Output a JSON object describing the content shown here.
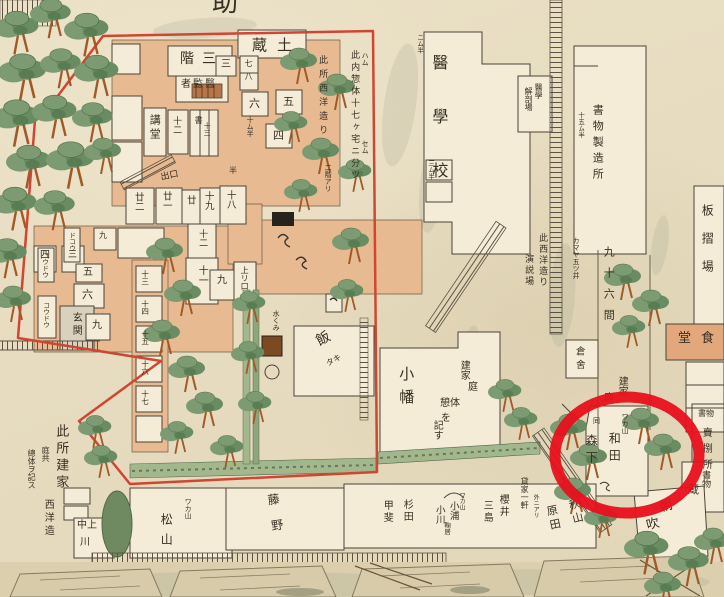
{
  "map": {
    "title_fragment": "助",
    "palette": {
      "ink": "#372f23",
      "boundary_red": "#cf4733",
      "annotation_red": "#e8101c",
      "corridor_salmon": "#e8ba92",
      "dining_salmon": "#e2a87c",
      "room_white": "#f4ecd6",
      "hedge_green": "#a2b88c",
      "tree_green": "#7d9b72",
      "moat_tan": "#dccfad"
    },
    "annotation": {
      "shape": "circle",
      "color": "#e8101c",
      "note": "red highlight circle over 和田 / 森下 plot"
    },
    "labels": [
      {
        "id": "title-fragment",
        "t": "助",
        "x": 212,
        "y": -10,
        "fs": 26,
        "d": "h"
      },
      {
        "id": "dozo",
        "t": "土蔵",
        "x": 252,
        "y": 38,
        "fs": 15,
        "d": "hr",
        "ls": 10
      },
      {
        "id": "sangai",
        "t": "三階",
        "x": 180,
        "y": 52,
        "fs": 14,
        "d": "hr",
        "ls": 8
      },
      {
        "id": "ikansha",
        "t": "醫監者",
        "x": 181,
        "y": 80,
        "fs": 10,
        "d": "hr",
        "ls": 2
      },
      {
        "id": "kodo",
        "t": "講堂",
        "x": 149,
        "y": 114,
        "fs": 11,
        "d": "v",
        "ls": 3
      },
      {
        "id": "juni-upper",
        "t": "十二",
        "x": 171,
        "y": 116,
        "fs": 9,
        "d": "v"
      },
      {
        "id": "sho",
        "t": "書",
        "x": 194,
        "y": 116,
        "fs": 8,
        "d": "v"
      },
      {
        "id": "jusan",
        "t": "十三",
        "x": 203,
        "y": 122,
        "fs": 7,
        "d": "v"
      },
      {
        "id": "num-3",
        "t": "三",
        "x": 221,
        "y": 60,
        "fs": 10,
        "d": "h"
      },
      {
        "id": "num-7-8",
        "t": "七八",
        "x": 244,
        "y": 59,
        "fs": 8,
        "d": "v",
        "ls": 5
      },
      {
        "id": "num-6",
        "t": "六",
        "x": 249,
        "y": 98,
        "fs": 11,
        "d": "h"
      },
      {
        "id": "num-5",
        "t": "五",
        "x": 283,
        "y": 96,
        "fs": 11,
        "d": "h"
      },
      {
        "id": "num-4",
        "t": "四",
        "x": 273,
        "y": 130,
        "fs": 11,
        "d": "h"
      },
      {
        "id": "konai-sobetai",
        "t": "此内惣体十七ヶ宅ニ分ツ",
        "x": 349,
        "y": 50,
        "fs": 9,
        "d": "v",
        "ls": 3
      },
      {
        "id": "kokosho-seiyo",
        "t": "此所西洋造り",
        "x": 317,
        "y": 55,
        "fs": 9,
        "d": "v",
        "ls": 5
      },
      {
        "id": "nikai-ari",
        "t": "二階アリ",
        "x": 324,
        "y": 164,
        "fs": 7,
        "d": "v"
      },
      {
        "id": "mark-hachimu",
        "t": "ハム",
        "x": 361,
        "y": 52,
        "fs": 7,
        "d": "v"
      },
      {
        "id": "mark-semu",
        "t": "セム",
        "x": 361,
        "y": 140,
        "fs": 7,
        "d": "v"
      },
      {
        "id": "mark-nimuhan",
        "t": "ニム半",
        "x": 416,
        "y": 34,
        "fs": 6.5,
        "d": "v"
      },
      {
        "id": "mark-jumuhan",
        "t": "十ム半",
        "x": 246,
        "y": 116,
        "fs": 7,
        "d": "v"
      },
      {
        "id": "deguchi",
        "t": "出口",
        "x": 160,
        "y": 174,
        "fs": 9,
        "d": "h",
        "r": -12
      },
      {
        "id": "room-18",
        "t": "十八",
        "x": 225,
        "y": 190,
        "fs": 9.5,
        "d": "v"
      },
      {
        "id": "room-19",
        "t": "十九",
        "x": 203,
        "y": 191,
        "fs": 9.5,
        "d": "v"
      },
      {
        "id": "room-20",
        "t": "廿",
        "x": 185,
        "y": 195,
        "fs": 9.5,
        "d": "v"
      },
      {
        "id": "room-21",
        "t": "廿一",
        "x": 161,
        "y": 191,
        "fs": 9.5,
        "d": "v"
      },
      {
        "id": "room-22",
        "t": "廿二",
        "x": 133,
        "y": 192,
        "fs": 9.5,
        "d": "v"
      },
      {
        "id": "mark-han",
        "t": "半",
        "x": 229,
        "y": 167,
        "fs": 8,
        "d": "h"
      },
      {
        "id": "room-12",
        "t": "十二",
        "x": 197,
        "y": 229,
        "fs": 9,
        "d": "v"
      },
      {
        "id": "room-11",
        "t": "十一",
        "x": 196,
        "y": 265,
        "fs": 10,
        "d": "v"
      },
      {
        "id": "room-9",
        "t": "九",
        "x": 217,
        "y": 276,
        "fs": 10,
        "d": "h"
      },
      {
        "id": "agariguchi",
        "t": "上リ口",
        "x": 240,
        "y": 266,
        "fs": 8,
        "d": "v"
      },
      {
        "id": "num-3b",
        "t": "三",
        "x": 68,
        "y": 251,
        "fs": 9,
        "d": "h"
      },
      {
        "id": "num-4b",
        "t": "四",
        "x": 40,
        "y": 251,
        "fs": 10,
        "d": "h"
      },
      {
        "id": "num-5b",
        "t": "五",
        "x": 83,
        "y": 268,
        "fs": 10,
        "d": "h"
      },
      {
        "id": "num-6b",
        "t": "六",
        "x": 82,
        "y": 289,
        "fs": 11,
        "d": "h"
      },
      {
        "id": "genkan",
        "t": "玄関",
        "x": 70,
        "y": 312,
        "fs": 10,
        "d": "v",
        "ls": 3
      },
      {
        "id": "num-9c",
        "t": "九",
        "x": 92,
        "y": 321,
        "fs": 10,
        "d": "h"
      },
      {
        "id": "num-9d",
        "t": "九",
        "x": 99,
        "y": 232,
        "fs": 8,
        "d": "h"
      },
      {
        "id": "koudou-1",
        "t": "コウドウ",
        "x": 42,
        "y": 302,
        "fs": 6.5,
        "d": "v"
      },
      {
        "id": "koudou-2",
        "t": "コウドウ",
        "x": 41,
        "y": 252,
        "fs": 6.5,
        "d": "v"
      },
      {
        "id": "dokou",
        "t": "ドコウ",
        "x": 68,
        "y": 232,
        "fs": 6.5,
        "d": "v"
      },
      {
        "id": "room-13",
        "t": "十三",
        "x": 141,
        "y": 270,
        "fs": 7.5,
        "d": "v"
      },
      {
        "id": "room-14",
        "t": "十四",
        "x": 141,
        "y": 300,
        "fs": 7.5,
        "d": "v"
      },
      {
        "id": "room-15",
        "t": "十五",
        "x": 141,
        "y": 330,
        "fs": 7.5,
        "d": "v"
      },
      {
        "id": "room-16",
        "t": "十六",
        "x": 141,
        "y": 360,
        "fs": 7.5,
        "d": "v"
      },
      {
        "id": "room-17",
        "t": "十七",
        "x": 141,
        "y": 390,
        "fs": 7.5,
        "d": "v"
      },
      {
        "id": "meshi",
        "t": "飯",
        "x": 314,
        "y": 336,
        "fs": 14,
        "d": "h",
        "r": -28
      },
      {
        "id": "meshi-taki",
        "t": "タキ",
        "x": 325,
        "y": 361,
        "fs": 8,
        "d": "h",
        "r": -28
      },
      {
        "id": "mizukumi",
        "t": "水くみ",
        "x": 272,
        "y": 310,
        "fs": 7,
        "d": "v"
      },
      {
        "id": "kamaya",
        "t": "カマヤ五ツ井",
        "x": 572,
        "y": 237,
        "fs": 7,
        "d": "v"
      },
      {
        "id": "kurasha",
        "t": "倉舍",
        "x": 574,
        "y": 346,
        "fs": 9.5,
        "d": "v",
        "ls": 4
      },
      {
        "id": "igakko",
        "t": "醫學校",
        "x": 430,
        "y": 54,
        "fs": 16,
        "d": "v",
        "ls": 38
      },
      {
        "id": "kaibo-igaku",
        "t": "醫學",
        "x": 534,
        "y": 83,
        "fs": 8,
        "d": "v"
      },
      {
        "id": "kaibo-jo",
        "t": "解剖場",
        "x": 524,
        "y": 87,
        "fs": 8,
        "d": "v"
      },
      {
        "id": "shomotsu-seizojo",
        "t": "書物製造所",
        "x": 592,
        "y": 104,
        "fs": 11,
        "d": "v",
        "ls": 5
      },
      {
        "id": "mark-15muhan",
        "t": "十五ム半",
        "x": 577,
        "y": 112,
        "fs": 6.5,
        "d": "v"
      },
      {
        "id": "mark-3muhan",
        "t": "三ム半",
        "x": 427,
        "y": 160,
        "fs": 6.5,
        "d": "v"
      },
      {
        "id": "itazuriba",
        "t": "板摺場",
        "x": 701,
        "y": 204,
        "fs": 12,
        "d": "v",
        "ls": 16
      },
      {
        "id": "shokudo",
        "t": "食堂",
        "x": 678,
        "y": 332,
        "fs": 13,
        "d": "hr",
        "ls": 10
      },
      {
        "id": "kono-seiyozukuri",
        "t": "此西洋造り",
        "x": 537,
        "y": 233,
        "fs": 9,
        "d": "v",
        "ls": 2
      },
      {
        "id": "enzetsuba",
        "t": "演説場",
        "x": 523,
        "y": 254,
        "fs": 9,
        "d": "v",
        "ls": 2
      },
      {
        "id": "kyujurokken",
        "t": "九十六間",
        "x": 603,
        "y": 246,
        "fs": 11,
        "d": "v",
        "ls": 10
      },
      {
        "id": "tateya-right",
        "t": "建家",
        "x": 616,
        "y": 376,
        "fs": 10,
        "d": "v"
      },
      {
        "id": "niwa-right",
        "t": "庭",
        "x": 604,
        "y": 394,
        "fs": 10,
        "d": "h"
      },
      {
        "id": "obata",
        "t": "小幡",
        "x": 398,
        "y": 366,
        "fs": 15,
        "d": "v",
        "ls": 8
      },
      {
        "id": "tateya-center",
        "t": "建家",
        "x": 458,
        "y": 360,
        "fs": 10,
        "d": "v"
      },
      {
        "id": "niwa-center",
        "t": "庭",
        "x": 468,
        "y": 383,
        "fs": 10,
        "d": "h"
      },
      {
        "id": "keitai-center",
        "t": "憩体",
        "x": 440,
        "y": 399,
        "fs": 10,
        "d": "h"
      },
      {
        "id": "wo-center",
        "t": "を",
        "x": 441,
        "y": 414,
        "fs": 10,
        "d": "h"
      },
      {
        "id": "kisu-center",
        "t": "記す",
        "x": 431,
        "y": 420,
        "fs": 10,
        "d": "v"
      },
      {
        "id": "wakayama-wada",
        "t": "ワカ山",
        "x": 621,
        "y": 413,
        "fs": 7,
        "d": "v"
      },
      {
        "id": "wada",
        "t": "和田",
        "x": 608,
        "y": 432,
        "fs": 12,
        "d": "v",
        "ls": 5
      },
      {
        "id": "do-mark",
        "t": "同",
        "x": 593,
        "y": 418,
        "fs": 7,
        "d": "h"
      },
      {
        "id": "morishita",
        "t": "森下",
        "x": 585,
        "y": 434,
        "fs": 12,
        "d": "v",
        "ls": 5
      },
      {
        "id": "shomotsu-uri-a",
        "t": "書物",
        "x": 698,
        "y": 410,
        "fs": 8,
        "d": "h"
      },
      {
        "id": "shomotsu-uri-b",
        "t": "賣捌所",
        "x": 700,
        "y": 427,
        "fs": 10,
        "d": "v",
        "ls": 6
      },
      {
        "id": "shomotsu-kura-a",
        "t": "書物",
        "x": 700,
        "y": 470,
        "fs": 9,
        "d": "v"
      },
      {
        "id": "shomotsu-kura-b",
        "t": "蔵",
        "x": 688,
        "y": 484,
        "fs": 11,
        "d": "h"
      },
      {
        "id": "asabuki-a",
        "t": "朝",
        "x": 658,
        "y": 502,
        "fs": 13,
        "d": "h",
        "r": -15
      },
      {
        "id": "asabuki-b",
        "t": "吹",
        "x": 645,
        "y": 520,
        "fs": 13,
        "d": "h",
        "r": -15
      },
      {
        "id": "konosho-tateya",
        "t": "此所建家",
        "x": 54,
        "y": 424,
        "fs": 13,
        "d": "v",
        "ls": 4
      },
      {
        "id": "niwatomo",
        "t": "庭共",
        "x": 41,
        "y": 446,
        "fs": 8,
        "d": "v"
      },
      {
        "id": "sotai-kisu",
        "t": "總体ヲ記ス",
        "x": 27,
        "y": 449,
        "fs": 8,
        "d": "v"
      },
      {
        "id": "seiyozukuri",
        "t": "西洋造",
        "x": 42,
        "y": 499,
        "fs": 10,
        "d": "v",
        "ls": 3
      },
      {
        "id": "nakamigawa-a",
        "t": "中上",
        "x": 77,
        "y": 521,
        "fs": 10,
        "d": "h"
      },
      {
        "id": "nakamigawa-b",
        "t": "川",
        "x": 80,
        "y": 538,
        "fs": 10,
        "d": "h"
      },
      {
        "id": "wakayama-matsu",
        "t": "ワカ山",
        "x": 184,
        "y": 498,
        "fs": 7,
        "d": "v"
      },
      {
        "id": "matsuyama",
        "t": "松山",
        "x": 160,
        "y": 513,
        "fs": 12,
        "d": "v",
        "ls": 8
      },
      {
        "id": "fujino",
        "t": "藤野",
        "x": 266,
        "y": 494,
        "fs": 12,
        "d": "v",
        "ls": 14,
        "r": -8
      },
      {
        "id": "akiyama",
        "t": "秋山",
        "x": 567,
        "y": 500,
        "fs": 11,
        "d": "v",
        "ls": 3,
        "r": -14
      },
      {
        "id": "harada",
        "t": "原田",
        "x": 545,
        "y": 506,
        "fs": 11,
        "d": "v",
        "ls": 3,
        "r": -12
      },
      {
        "id": "kashiya",
        "t": "貸家一軒",
        "x": 520,
        "y": 477,
        "fs": 8,
        "d": "v"
      },
      {
        "id": "hoka-ni-ari",
        "t": "外ニアリ",
        "x": 532,
        "y": 494,
        "fs": 6,
        "d": "v"
      },
      {
        "id": "sakurai",
        "t": "櫻井",
        "x": 497,
        "y": 494,
        "fs": 10,
        "d": "v",
        "ls": 2
      },
      {
        "id": "mishima",
        "t": "三島",
        "x": 481,
        "y": 500,
        "fs": 10,
        "d": "v",
        "ls": 2
      },
      {
        "id": "wakayama-koura",
        "t": "ワカ山",
        "x": 458,
        "y": 492,
        "fs": 6,
        "d": "v"
      },
      {
        "id": "koura",
        "t": "小浦",
        "x": 448,
        "y": 501,
        "fs": 9.5,
        "d": "v"
      },
      {
        "id": "ogawa",
        "t": "小川",
        "x": 434,
        "y": 505,
        "fs": 9.5,
        "d": "v"
      },
      {
        "id": "marii",
        "t": "鞠居",
        "x": 443,
        "y": 522,
        "fs": 6.5,
        "d": "v"
      },
      {
        "id": "sugita",
        "t": "杉田",
        "x": 401,
        "y": 499,
        "fs": 10,
        "d": "v",
        "ls": 2
      },
      {
        "id": "kai",
        "t": "甲斐",
        "x": 381,
        "y": 500,
        "fs": 10,
        "d": "v",
        "ls": 2
      }
    ]
  }
}
